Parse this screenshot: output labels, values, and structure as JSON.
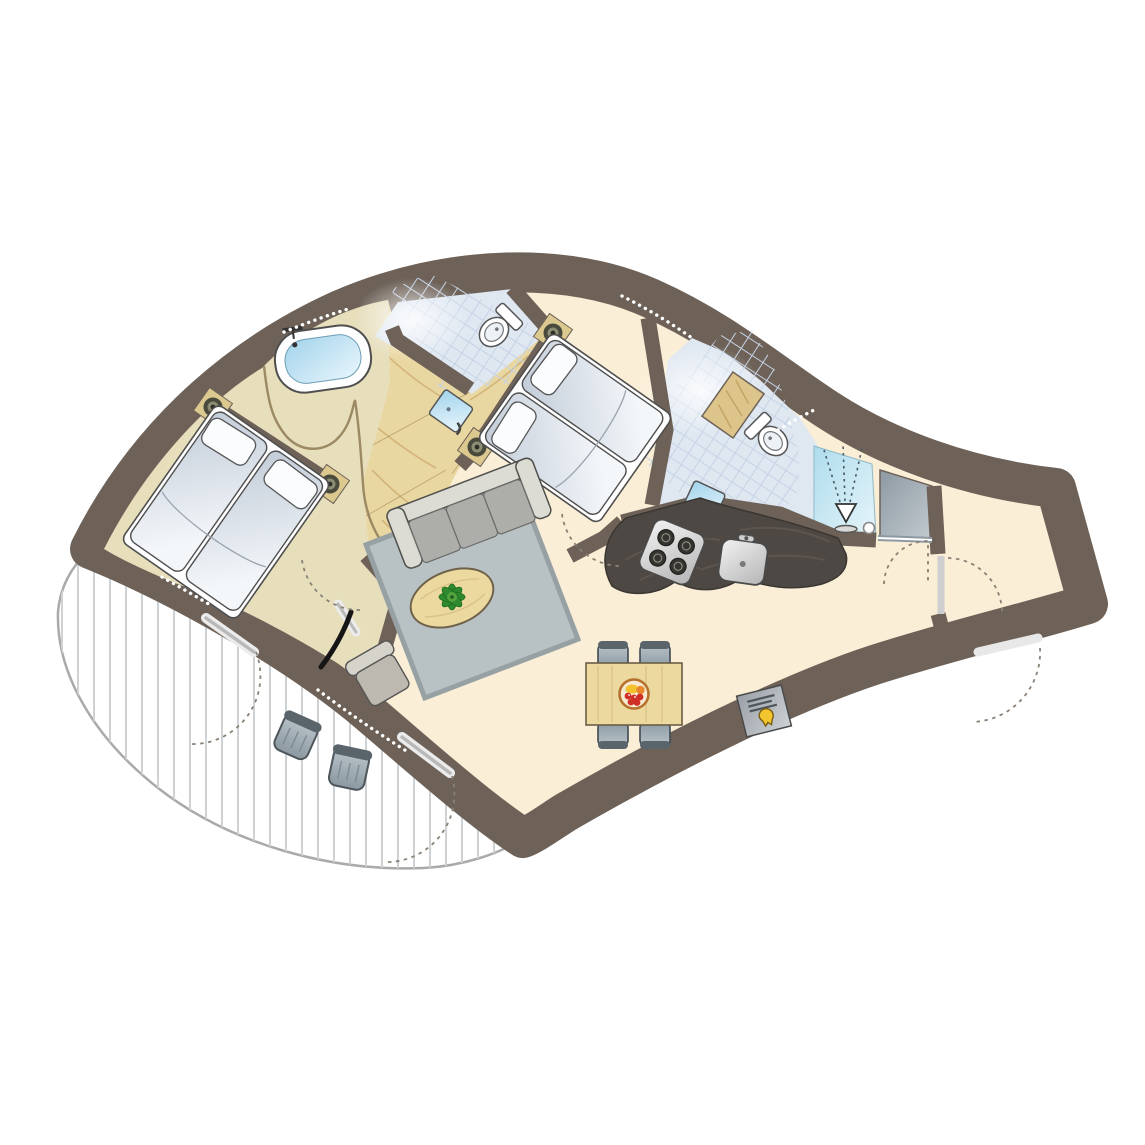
{
  "title": "curved-holiday-home-floor-plan",
  "colors": {
    "wall": "#6e6258",
    "floor": "#faeed6",
    "bedroom_floor": "#e7debc",
    "wood": "#e9d7a2",
    "wood_grain": "#cfae72",
    "wood_line": "#b3965e",
    "tile": "#dfe7f1",
    "tile_line": "#c6d3e6",
    "water_dark": "#a9d7ec",
    "water_light": "#e9f6fc",
    "rug": "#b8c1c4",
    "rug_border": "#97a1a4",
    "sofa_base": "#dcdbd4",
    "sofa_cushion": "#adadaa",
    "counter": "#4d4843",
    "counter_streak": "#6a6158",
    "steel_light": "#f0f0f0",
    "steel_dark": "#bdbdbd",
    "chair_light": "#b7c3c9",
    "chair_dark": "#5a646b",
    "table_wood": "#ecd9a0",
    "deck_stripe": "#cfd2d4",
    "deck_edge": "#aaaaaa",
    "post": "#dcc98f",
    "post_ring": "#4a4a3c",
    "plant_green": "#2e8a2e",
    "plant_light": "#53a33f",
    "fruit_red": "#d02f26",
    "fruit_yellow": "#f2c12b",
    "fruit_orange": "#e8872c",
    "bowl_rim": "#b5722d",
    "logo_yellow": "#f3c52e",
    "arc": "#8a8276",
    "door_black": "#151515",
    "outline": "#4f4f4f",
    "white": "#ffffff"
  },
  "rooms": [
    "bedroom-1",
    "bathroom-with-bathtub",
    "wc",
    "hallway",
    "bedroom-2",
    "living-room",
    "kitchen",
    "shower-room",
    "storage-closet",
    "entrance-hall",
    "dining-area",
    "terrace"
  ],
  "furniture": [
    "double-bed-1",
    "double-bed-2",
    "bathtub",
    "toilet-1",
    "toilet-2",
    "washbasin-1",
    "washbasin-2",
    "vanity-cabinet",
    "shower",
    "wardrobe",
    "sofa",
    "rug",
    "coffee-table",
    "plant",
    "armchair",
    "kitchen-counter",
    "hob",
    "kitchen-sink",
    "dining-table",
    "dining-chair",
    "fruit-bowl",
    "doormat",
    "terrace-chair-1",
    "terrace-chair-2"
  ]
}
